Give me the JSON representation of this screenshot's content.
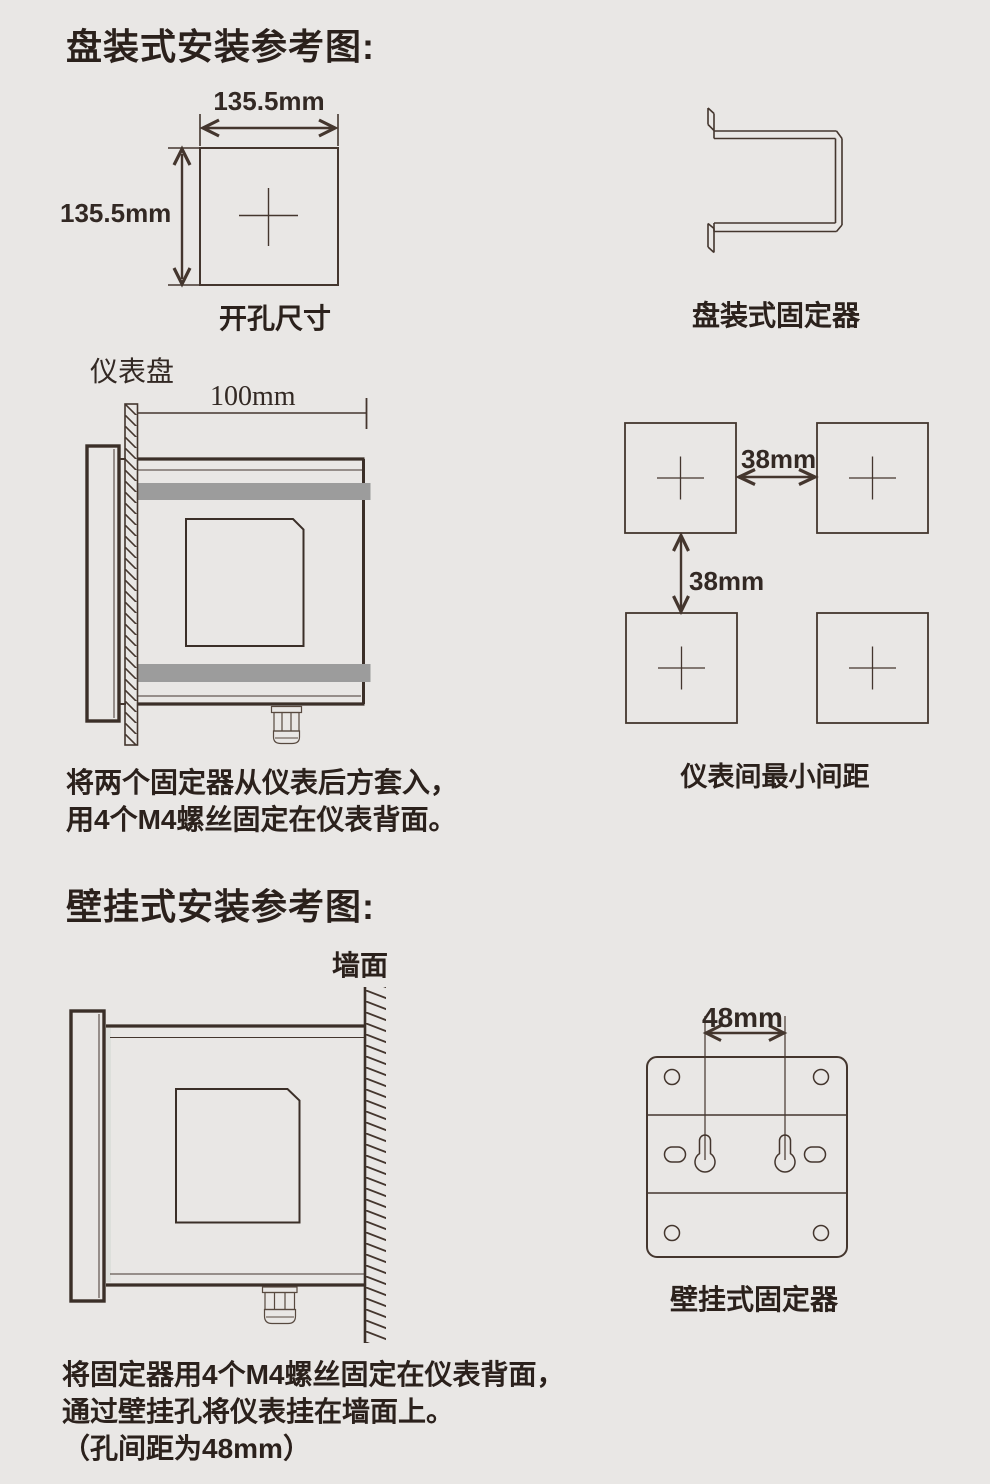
{
  "panel": {
    "title": "盘装式安装参考图:",
    "cutout": {
      "width_label": "135.5mm",
      "height_label": "135.5mm",
      "caption": "开孔尺寸"
    },
    "fixator_caption": "盘装式固定器",
    "side": {
      "panel_label": "仪表盘",
      "depth_label": "100mm"
    },
    "spacing": {
      "h_label": "38mm",
      "v_label": "38mm",
      "caption": "仪表间最小间距"
    },
    "instruction": "将两个固定器从仪表后方套入，\n用4个M4螺丝固定在仪表背面。"
  },
  "wall": {
    "title": "壁挂式安装参考图:",
    "side": {
      "wall_label": "墙面"
    },
    "fixator": {
      "pitch_label": "48mm",
      "caption": "壁挂式固定器"
    },
    "instruction": "将固定器用4个M4螺丝固定在仪表背面，\n通过壁挂孔将仪表挂在墙面上。\n（孔间距为48mm）"
  },
  "colors": {
    "background": "#e9e7e5",
    "line": "#44362e",
    "text": "#2b211c",
    "band": "#9c9c9c"
  }
}
